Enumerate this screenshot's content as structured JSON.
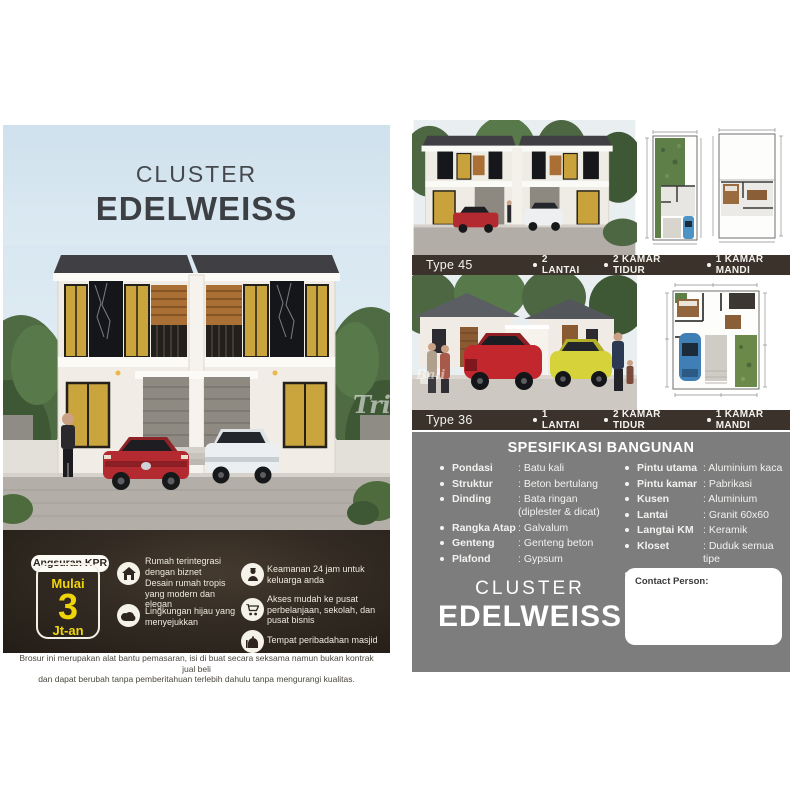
{
  "left_page": {
    "title_line1": "CLUSTER",
    "title_line2": "EDELWEISS",
    "watermark": "Trib",
    "promo": {
      "badge": "Angsuran KPR",
      "price_prefix": "Mulai",
      "price_value": "3",
      "price_suffix": "Jt-an"
    },
    "features_col1": [
      {
        "icon": "house-icon",
        "text": "Rumah terintegrasi dengan biznet"
      },
      {
        "icon": "",
        "text": "Desain rumah tropis yang modern dan elegan"
      },
      {
        "icon": "cloud-icon",
        "text": "Lingkungan hijau yang menyejukkan"
      }
    ],
    "features_col2": [
      {
        "icon": "security-guard-icon",
        "text": "Keamanan 24 jam untuk keluarga anda"
      },
      {
        "icon": "shopping-cart-icon",
        "text": "Akses mudah ke pusat perbelanjaan, sekolah, dan pusat bisnis"
      },
      {
        "icon": "mosque-icon",
        "text": "Tempat peribadahan masjid"
      }
    ],
    "disclaimer_line1": "Brosur ini merupakan alat bantu pemasaran, isi di buat secara seksama namun bukan kontrak jual beli",
    "disclaimer_line2": "dan dapat berubah tanpa pemberitahuan terlebih dahulu tanpa mengurangi kualitas."
  },
  "right_page": {
    "type45": {
      "label": "Type 45",
      "features": [
        "2 LANTAI",
        "2 KAMAR TIDUR",
        "1 KAMAR MANDI"
      ]
    },
    "type36": {
      "label": "Type 36",
      "features": [
        "1 LANTAI",
        "2 KAMAR TIDUR",
        "1 KAMAR MANDI"
      ],
      "watermark": "Bali"
    },
    "specs": {
      "title": "SPESIFIKASI BANGUNAN",
      "col1": [
        {
          "label": "Pondasi",
          "value": ": Batu kali"
        },
        {
          "label": "Struktur",
          "value": ": Beton bertulang"
        },
        {
          "label": "Dinding",
          "value": ": Bata ringan (diplester & dicat)"
        },
        {
          "label": "Rangka Atap",
          "value": ": Galvalum"
        },
        {
          "label": "Genteng",
          "value": ": Genteng beton"
        },
        {
          "label": "Plafond",
          "value": ": Gypsum"
        }
      ],
      "col2": [
        {
          "label": "Pintu utama",
          "value": ": Aluminium kaca"
        },
        {
          "label": "Pintu kamar",
          "value": ": Pabrikasi"
        },
        {
          "label": "Kusen",
          "value": ": Aluminium"
        },
        {
          "label": "Lantai",
          "value": ": Granit 60x60"
        },
        {
          "label": "Langtai KM",
          "value": ": Keramik"
        },
        {
          "label": "Kloset",
          "value": ": Duduk semua tipe"
        },
        {
          "label": "Listrik",
          "value": ":1300 Watt"
        },
        {
          "label": "Air",
          "value": ": Air bersih"
        }
      ]
    },
    "brand_line1": "CLUSTER",
    "brand_line2": "EDELWEISS",
    "contact_label": "Contact Person:"
  },
  "colors": {
    "accent_yellow": "#f0d40a",
    "dark_section": "#2d251e",
    "type_bar": "#3a322b",
    "gray_section": "#7d7d7d",
    "sky": "#d9e8f1",
    "title_gray": "#3d4145"
  }
}
